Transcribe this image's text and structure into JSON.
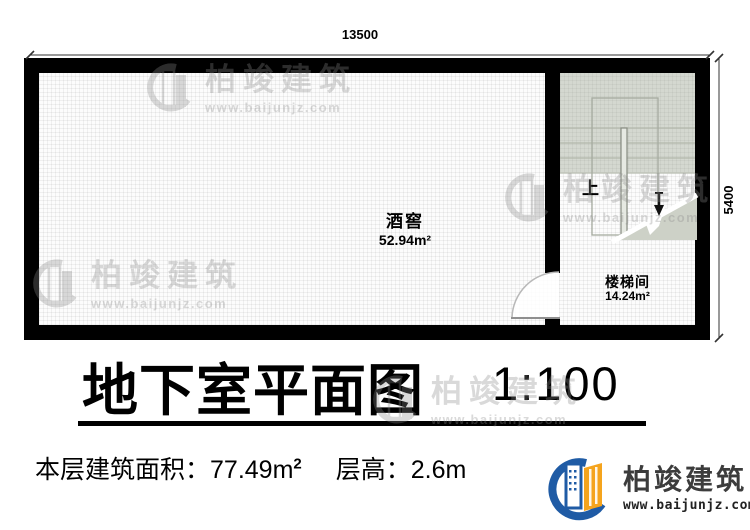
{
  "dimensions": {
    "top": "13500",
    "right": "5400"
  },
  "rooms": {
    "cellar": {
      "name": "酒窖",
      "area": "52.94m²"
    },
    "stairwell": {
      "name": "楼梯间",
      "area": "14.24m²"
    },
    "stair_direction": "上"
  },
  "title": {
    "text": "地下室平面图",
    "scale": "1:100"
  },
  "info": {
    "area_label": "本层建筑面积：",
    "area_value": "77.49m",
    "area_sup": "2",
    "height_label": "层高：",
    "height_value": "2.6m"
  },
  "brand": {
    "name": "柏竣建筑",
    "website": "www.baijunjz.com"
  },
  "watermark": {
    "name": "柏竣建筑",
    "website": "www.baijunjz.com"
  },
  "colors": {
    "wall": "#000000",
    "stair_shade": "#d4d8d0",
    "brand_blue": "#1f5ba5",
    "brand_orange": "#f5a41d",
    "watermark_gray": "#8a8a8a"
  }
}
